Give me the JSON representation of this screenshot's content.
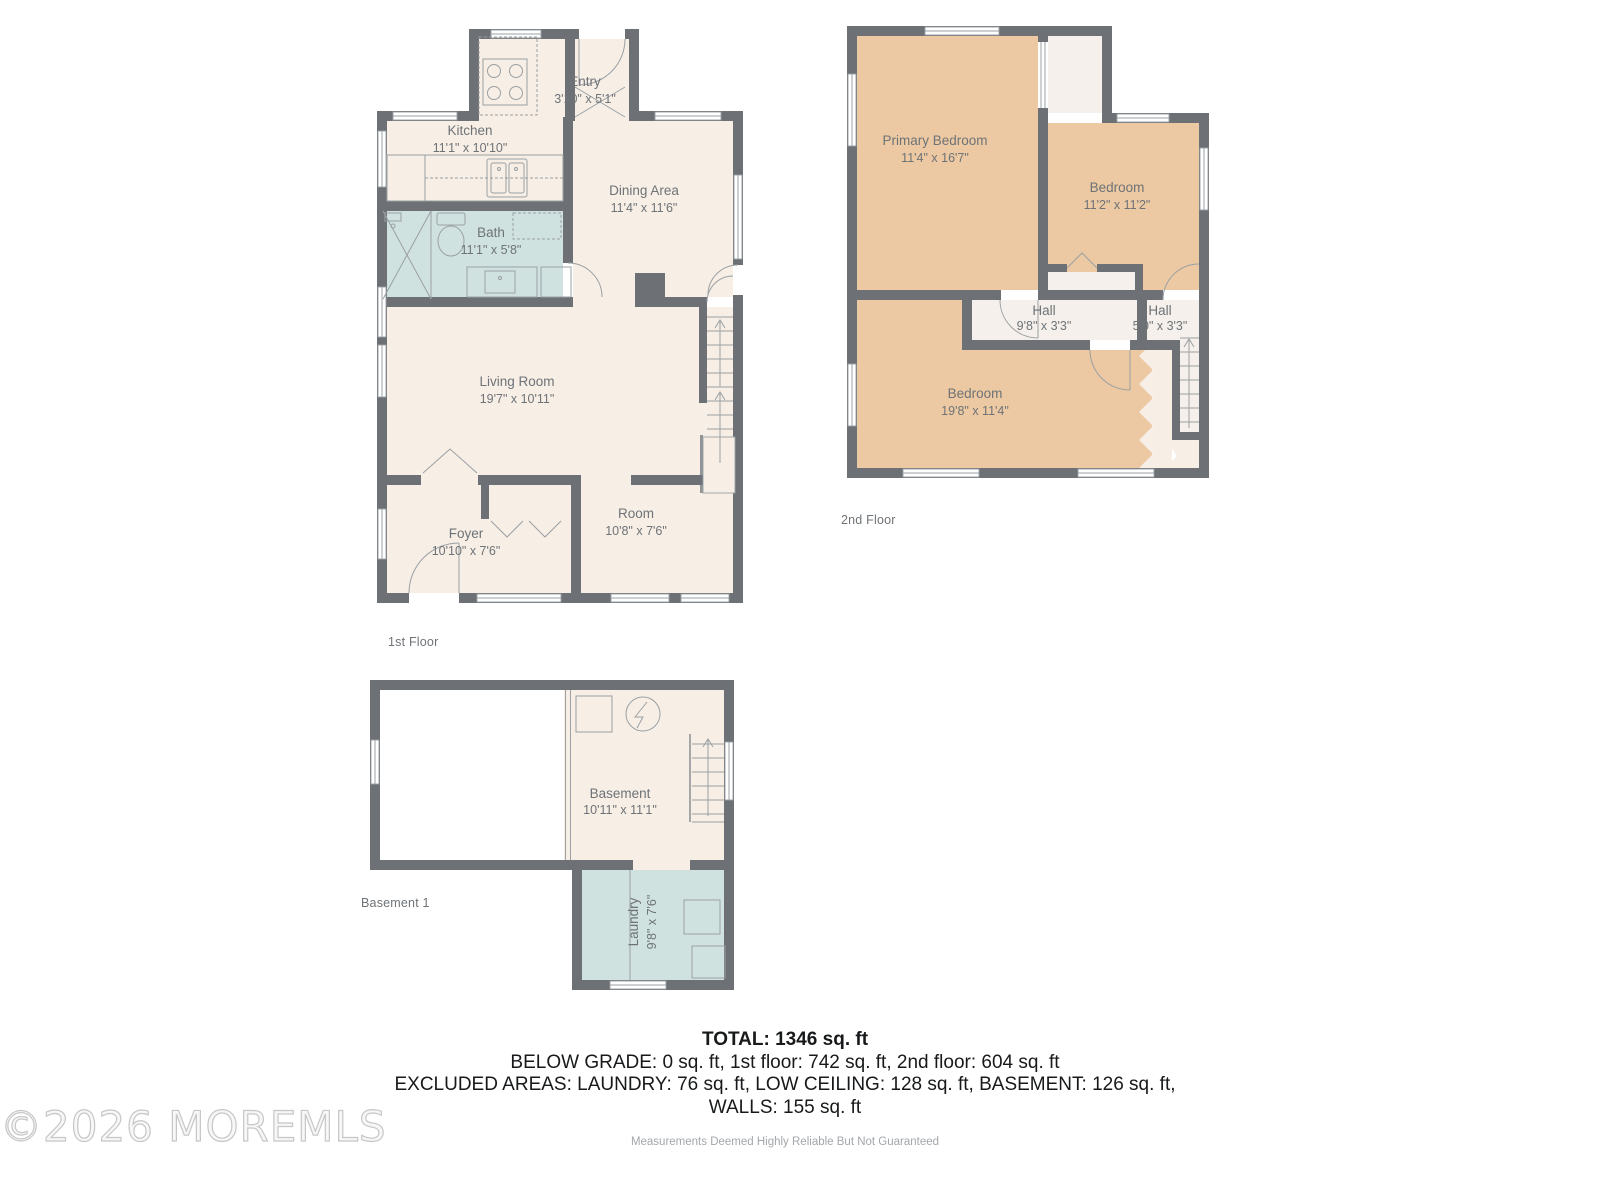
{
  "colors": {
    "wall": "#6d7175",
    "room_beige": "#f7eee6",
    "room_tan": "#ecc9a2",
    "room_blue": "#d0e2e0",
    "hall_white": "#f5f0eb",
    "line": "#9aa0a3"
  },
  "watermark": "©2026 MOREMLS",
  "floors": [
    {
      "label": "1st Floor",
      "rooms": [
        {
          "name": "Kitchen",
          "dims": "11'1\" x 10'10\""
        },
        {
          "name": "Entry",
          "dims": "3'10\" x 5'1\""
        },
        {
          "name": "Dining Area",
          "dims": "11'4\" x 11'6\""
        },
        {
          "name": "Bath",
          "dims": "11'1\" x 5'8\""
        },
        {
          "name": "Living Room",
          "dims": "19'7\" x 10'11\""
        },
        {
          "name": "Foyer",
          "dims": "10'10\" x 7'6\""
        },
        {
          "name": "Room",
          "dims": "10'8\" x 7'6\""
        }
      ]
    },
    {
      "label": "2nd Floor",
      "rooms": [
        {
          "name": "Primary Bedroom",
          "dims": "11'4\" x 16'7\""
        },
        {
          "name": "Bedroom",
          "dims": "11'2\" x 11'2\""
        },
        {
          "name": "Hall",
          "dims": "9'8\" x 3'3\""
        },
        {
          "name": "Hall",
          "dims": "5'0\" x 3'3\""
        },
        {
          "name": "Bedroom",
          "dims": "19'8\" x 11'4\""
        }
      ]
    },
    {
      "label": "Basement 1",
      "rooms": [
        {
          "name": "Basement",
          "dims": "10'11\" x 11'1\""
        },
        {
          "name": "Laundry",
          "dims": "9'8\" x 7'6\""
        }
      ]
    }
  ],
  "summary": {
    "total": "TOTAL: 1346 sq. ft",
    "line2": "BELOW GRADE: 0 sq. ft, 1st floor: 742 sq. ft, 2nd floor: 604 sq. ft",
    "line3": "EXCLUDED AREAS: LAUNDRY: 76 sq. ft, LOW CEILING: 128 sq. ft, BASEMENT: 126 sq. ft,",
    "line4": "WALLS: 155 sq. ft"
  },
  "disclaimer": "Measurements Deemed Highly Reliable But Not Guaranteed"
}
